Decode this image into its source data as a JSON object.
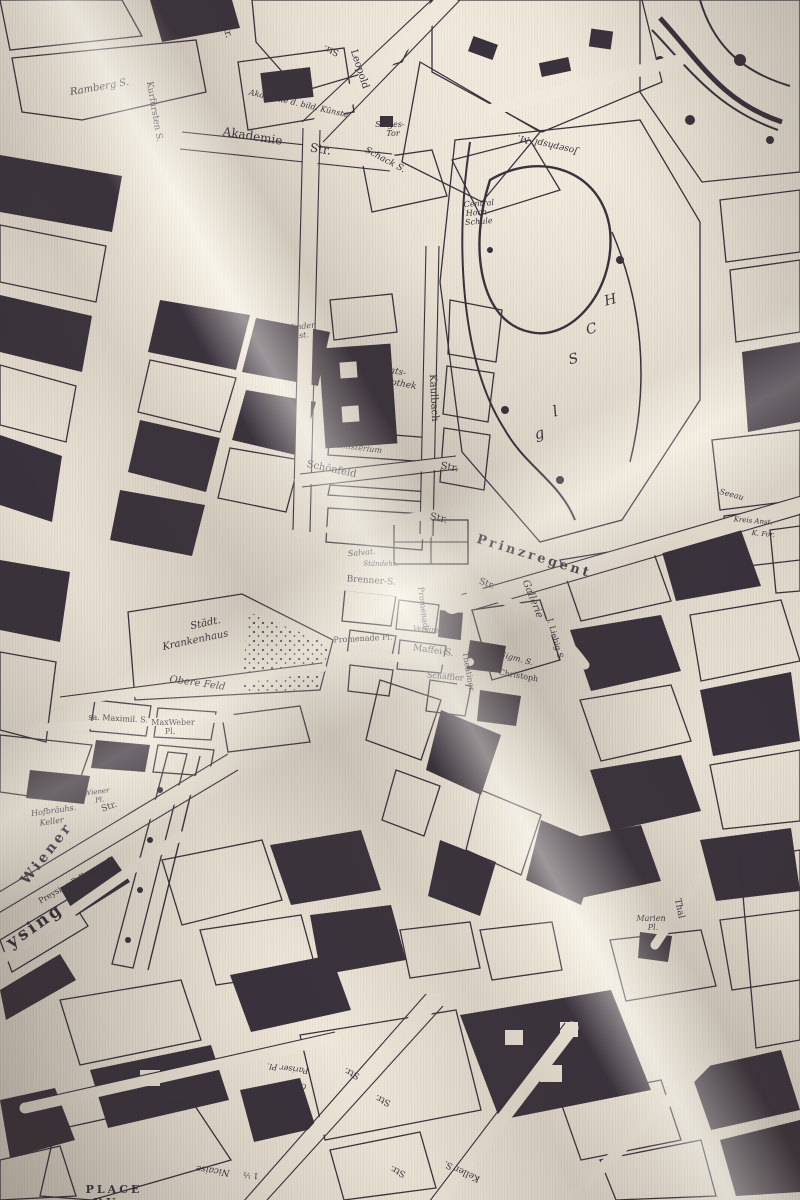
{
  "scene": {
    "type": "photograph-of-printed-fabric",
    "print_subject": "antique engraved city map of Munich with bird's-eye quarters"
  },
  "palette": {
    "fabric": "#f1eadc",
    "fabric_highlight": "#faf6ec",
    "fabric_shadow": "#b9af a1",
    "ink": "#2a2330"
  },
  "map": {
    "labels": [
      {
        "t": "Ramberg S.",
        "x": 100,
        "y": 90,
        "r": -10,
        "s": 10,
        "c": "it"
      },
      {
        "t": "Kurfürsten S.",
        "x": 152,
        "y": 112,
        "r": 80,
        "s": 9,
        "c": ""
      },
      {
        "t": "Str.",
        "x": 224,
        "y": 30,
        "r": 75,
        "s": 10,
        "c": ""
      },
      {
        "t": "Akademie d. bild. Künste",
        "x": 298,
        "y": 106,
        "r": 13,
        "s": 8,
        "c": "it"
      },
      {
        "t": "Akademie",
        "x": 252,
        "y": 140,
        "r": 9,
        "s": 12,
        "c": ""
      },
      {
        "t": "Str.",
        "x": 320,
        "y": 153,
        "r": 9,
        "s": 12,
        "c": ""
      },
      {
        "t": "Leopold",
        "x": 357,
        "y": 70,
        "r": 72,
        "s": 10,
        "c": ""
      },
      {
        "t": "Sieges-",
        "x": 390,
        "y": 127,
        "r": 0,
        "s": 8,
        "c": "it"
      },
      {
        "t": "Tor",
        "x": 393,
        "y": 136,
        "r": 0,
        "s": 8,
        "c": "it"
      },
      {
        "t": "Schack S.",
        "x": 384,
        "y": 162,
        "r": 28,
        "s": 9,
        "c": "it"
      },
      {
        "t": "Josephspl. M.",
        "x": 548,
        "y": 142,
        "r": 193,
        "s": 9,
        "c": "it"
      },
      {
        "t": "Central",
        "x": 479,
        "y": 206,
        "r": -4,
        "s": 8,
        "c": "it"
      },
      {
        "t": "Hoch-",
        "x": 478,
        "y": 215,
        "r": -4,
        "s": 8,
        "c": "it"
      },
      {
        "t": "Schule",
        "x": 479,
        "y": 224,
        "r": -4,
        "s": 8,
        "c": "it"
      },
      {
        "t": "Str.",
        "x": 332,
        "y": 48,
        "r": 200,
        "s": 9,
        "c": ""
      },
      {
        "t": "Blinden",
        "x": 301,
        "y": 329,
        "r": -6,
        "s": 8,
        "c": "it"
      },
      {
        "t": "Inst.",
        "x": 300,
        "y": 338,
        "r": -6,
        "s": 8,
        "c": "it"
      },
      {
        "t": "Staats-",
        "x": 390,
        "y": 373,
        "r": 10,
        "s": 9,
        "c": "it"
      },
      {
        "t": "Bibliothek",
        "x": 393,
        "y": 385,
        "r": 10,
        "s": 9,
        "c": "it"
      },
      {
        "t": "Kaulbach",
        "x": 431,
        "y": 398,
        "r": 87,
        "s": 10,
        "c": ""
      },
      {
        "t": "Str.",
        "x": 449,
        "y": 470,
        "r": 10,
        "s": 10,
        "c": ""
      },
      {
        "t": "Kriegs-",
        "x": 352,
        "y": 440,
        "r": 7,
        "s": 8,
        "c": "it"
      },
      {
        "t": "Ministerium",
        "x": 357,
        "y": 450,
        "r": 7,
        "s": 8,
        "c": "it"
      },
      {
        "t": "Schönfeld",
        "x": 331,
        "y": 472,
        "r": 12,
        "s": 10,
        "c": ""
      },
      {
        "t": "Str.",
        "x": 438,
        "y": 521,
        "r": 12,
        "s": 10,
        "c": ""
      },
      {
        "t": "Prinzregent",
        "x": 533,
        "y": 560,
        "r": 17,
        "s": 13,
        "c": "sp"
      },
      {
        "t": "Gallerie",
        "x": 530,
        "y": 600,
        "r": 68,
        "s": 10,
        "c": "it"
      },
      {
        "t": "Str.",
        "x": 486,
        "y": 586,
        "r": 20,
        "s": 9,
        "c": ""
      },
      {
        "t": "Brenner-S.",
        "x": 371,
        "y": 583,
        "r": 4,
        "s": 9,
        "c": ""
      },
      {
        "t": "Salvat.",
        "x": 362,
        "y": 555,
        "r": -5,
        "s": 8,
        "c": "it"
      },
      {
        "t": "Ständehs.",
        "x": 381,
        "y": 566,
        "r": 0,
        "s": 7,
        "c": "it"
      },
      {
        "t": "Promenade",
        "x": 421,
        "y": 610,
        "r": 83,
        "s": 8,
        "c": ""
      },
      {
        "t": "Promenade Pl.",
        "x": 363,
        "y": 641,
        "r": -3,
        "s": 8,
        "c": ""
      },
      {
        "t": "Vereins-Bk.",
        "x": 433,
        "y": 632,
        "r": 5,
        "s": 7,
        "c": "it"
      },
      {
        "t": "Maffei-S.",
        "x": 433,
        "y": 653,
        "r": 8,
        "s": 9,
        "c": ""
      },
      {
        "t": "Schäffler",
        "x": 445,
        "y": 679,
        "r": 5,
        "s": 8,
        "c": ""
      },
      {
        "t": "Theatiner",
        "x": 466,
        "y": 672,
        "r": 80,
        "s": 8,
        "c": ""
      },
      {
        "t": "Sigm. S.",
        "x": 516,
        "y": 661,
        "r": 15,
        "s": 8,
        "c": "it"
      },
      {
        "t": "Christoph",
        "x": 518,
        "y": 678,
        "r": 10,
        "s": 8,
        "c": ""
      },
      {
        "t": "J. Liebig S.",
        "x": 553,
        "y": 640,
        "r": 75,
        "s": 8,
        "c": ""
      },
      {
        "t": "Städt.",
        "x": 206,
        "y": 626,
        "r": -12,
        "s": 10,
        "c": "it"
      },
      {
        "t": "Krankenhaus",
        "x": 196,
        "y": 643,
        "r": -12,
        "s": 10,
        "c": "it"
      },
      {
        "t": "Obere Feld",
        "x": 197,
        "y": 686,
        "r": 8,
        "s": 10,
        "c": "it"
      },
      {
        "t": "sa. Maximil. S.",
        "x": 118,
        "y": 721,
        "r": 3,
        "s": 8,
        "c": ""
      },
      {
        "t": "MaxWeber",
        "x": 173,
        "y": 725,
        "r": 0,
        "s": 8,
        "c": ""
      },
      {
        "t": "Pl.",
        "x": 170,
        "y": 734,
        "r": 0,
        "s": 8,
        "c": ""
      },
      {
        "t": "Wiener",
        "x": 97,
        "y": 794,
        "r": -8,
        "s": 7,
        "c": "it"
      },
      {
        "t": "Pl.",
        "x": 100,
        "y": 802,
        "r": -8,
        "s": 7,
        "c": "it"
      },
      {
        "t": "Str.",
        "x": 110,
        "y": 809,
        "r": -20,
        "s": 9,
        "c": ""
      },
      {
        "t": "Hofbräuhs.",
        "x": 54,
        "y": 813,
        "r": -8,
        "s": 8,
        "c": "it"
      },
      {
        "t": "Keller",
        "x": 52,
        "y": 824,
        "r": -8,
        "s": 8,
        "c": "it"
      },
      {
        "t": "Wiener",
        "x": 50,
        "y": 856,
        "r": -52,
        "s": 14,
        "c": "sp"
      },
      {
        "t": "Preysing P. Eggern-S.",
        "x": 78,
        "y": 882,
        "r": -30,
        "s": 8,
        "c": ""
      },
      {
        "t": "ysing",
        "x": 38,
        "y": 930,
        "r": -35,
        "s": 17,
        "c": "sp"
      },
      {
        "t": "Marien",
        "x": 651,
        "y": 921,
        "r": 0,
        "s": 8,
        "c": "it"
      },
      {
        "t": "Pl.",
        "x": 653,
        "y": 930,
        "r": 0,
        "s": 8,
        "c": "it"
      },
      {
        "t": "Thal",
        "x": 677,
        "y": 909,
        "r": 78,
        "s": 9,
        "c": ""
      },
      {
        "t": "Paradies.",
        "x": 766,
        "y": 387,
        "r": 5,
        "s": 7,
        "c": "it"
      },
      {
        "t": "Seeau",
        "x": 731,
        "y": 497,
        "r": 15,
        "s": 8,
        "c": "it"
      },
      {
        "t": "Kreis Anst.",
        "x": 753,
        "y": 523,
        "r": 5,
        "s": 7,
        "c": "it"
      },
      {
        "t": "K. For.",
        "x": 763,
        "y": 536,
        "r": 5,
        "s": 7,
        "c": "it"
      },
      {
        "t": "g",
        "x": 541,
        "y": 438,
        "r": -15,
        "s": 15,
        "c": "big"
      },
      {
        "t": "l",
        "x": 557,
        "y": 416,
        "r": -15,
        "s": 15,
        "c": "big"
      },
      {
        "t": "S",
        "x": 575,
        "y": 363,
        "r": -15,
        "s": 14,
        "c": "big"
      },
      {
        "t": "C",
        "x": 593,
        "y": 333,
        "r": -15,
        "s": 14,
        "c": "big"
      },
      {
        "t": "H",
        "x": 612,
        "y": 304,
        "r": -15,
        "s": 14,
        "c": "big"
      },
      {
        "t": "Pariser Pl.",
        "x": 288,
        "y": 1066,
        "r": 187,
        "s": 8,
        "c": "it"
      },
      {
        "t": "Grä.",
        "x": 298,
        "y": 1083,
        "r": 190,
        "s": 8,
        "c": "it"
      },
      {
        "t": "Str.",
        "x": 353,
        "y": 1071,
        "r": 205,
        "s": 9,
        "c": ""
      },
      {
        "t": "Str.",
        "x": 384,
        "y": 1098,
        "r": 205,
        "s": 9,
        "c": ""
      },
      {
        "t": "Str.",
        "x": 399,
        "y": 1169,
        "r": 205,
        "s": 9,
        "c": ""
      },
      {
        "t": "Keller S.",
        "x": 463,
        "y": 1169,
        "r": 205,
        "s": 9,
        "c": ""
      },
      {
        "t": "Nicaise",
        "x": 213,
        "y": 1168,
        "r": 188,
        "s": 9,
        "c": "it"
      },
      {
        "t": "1 ½",
        "x": 251,
        "y": 1173,
        "r": 185,
        "s": 8,
        "c": ""
      },
      {
        "t": "PLACE",
        "x": 114,
        "y": 1193,
        "r": 0,
        "s": 11,
        "c": "sp"
      },
      {
        "t": "DU",
        "x": 106,
        "y": 1206,
        "r": 0,
        "s": 11,
        "c": "sp"
      }
    ]
  }
}
